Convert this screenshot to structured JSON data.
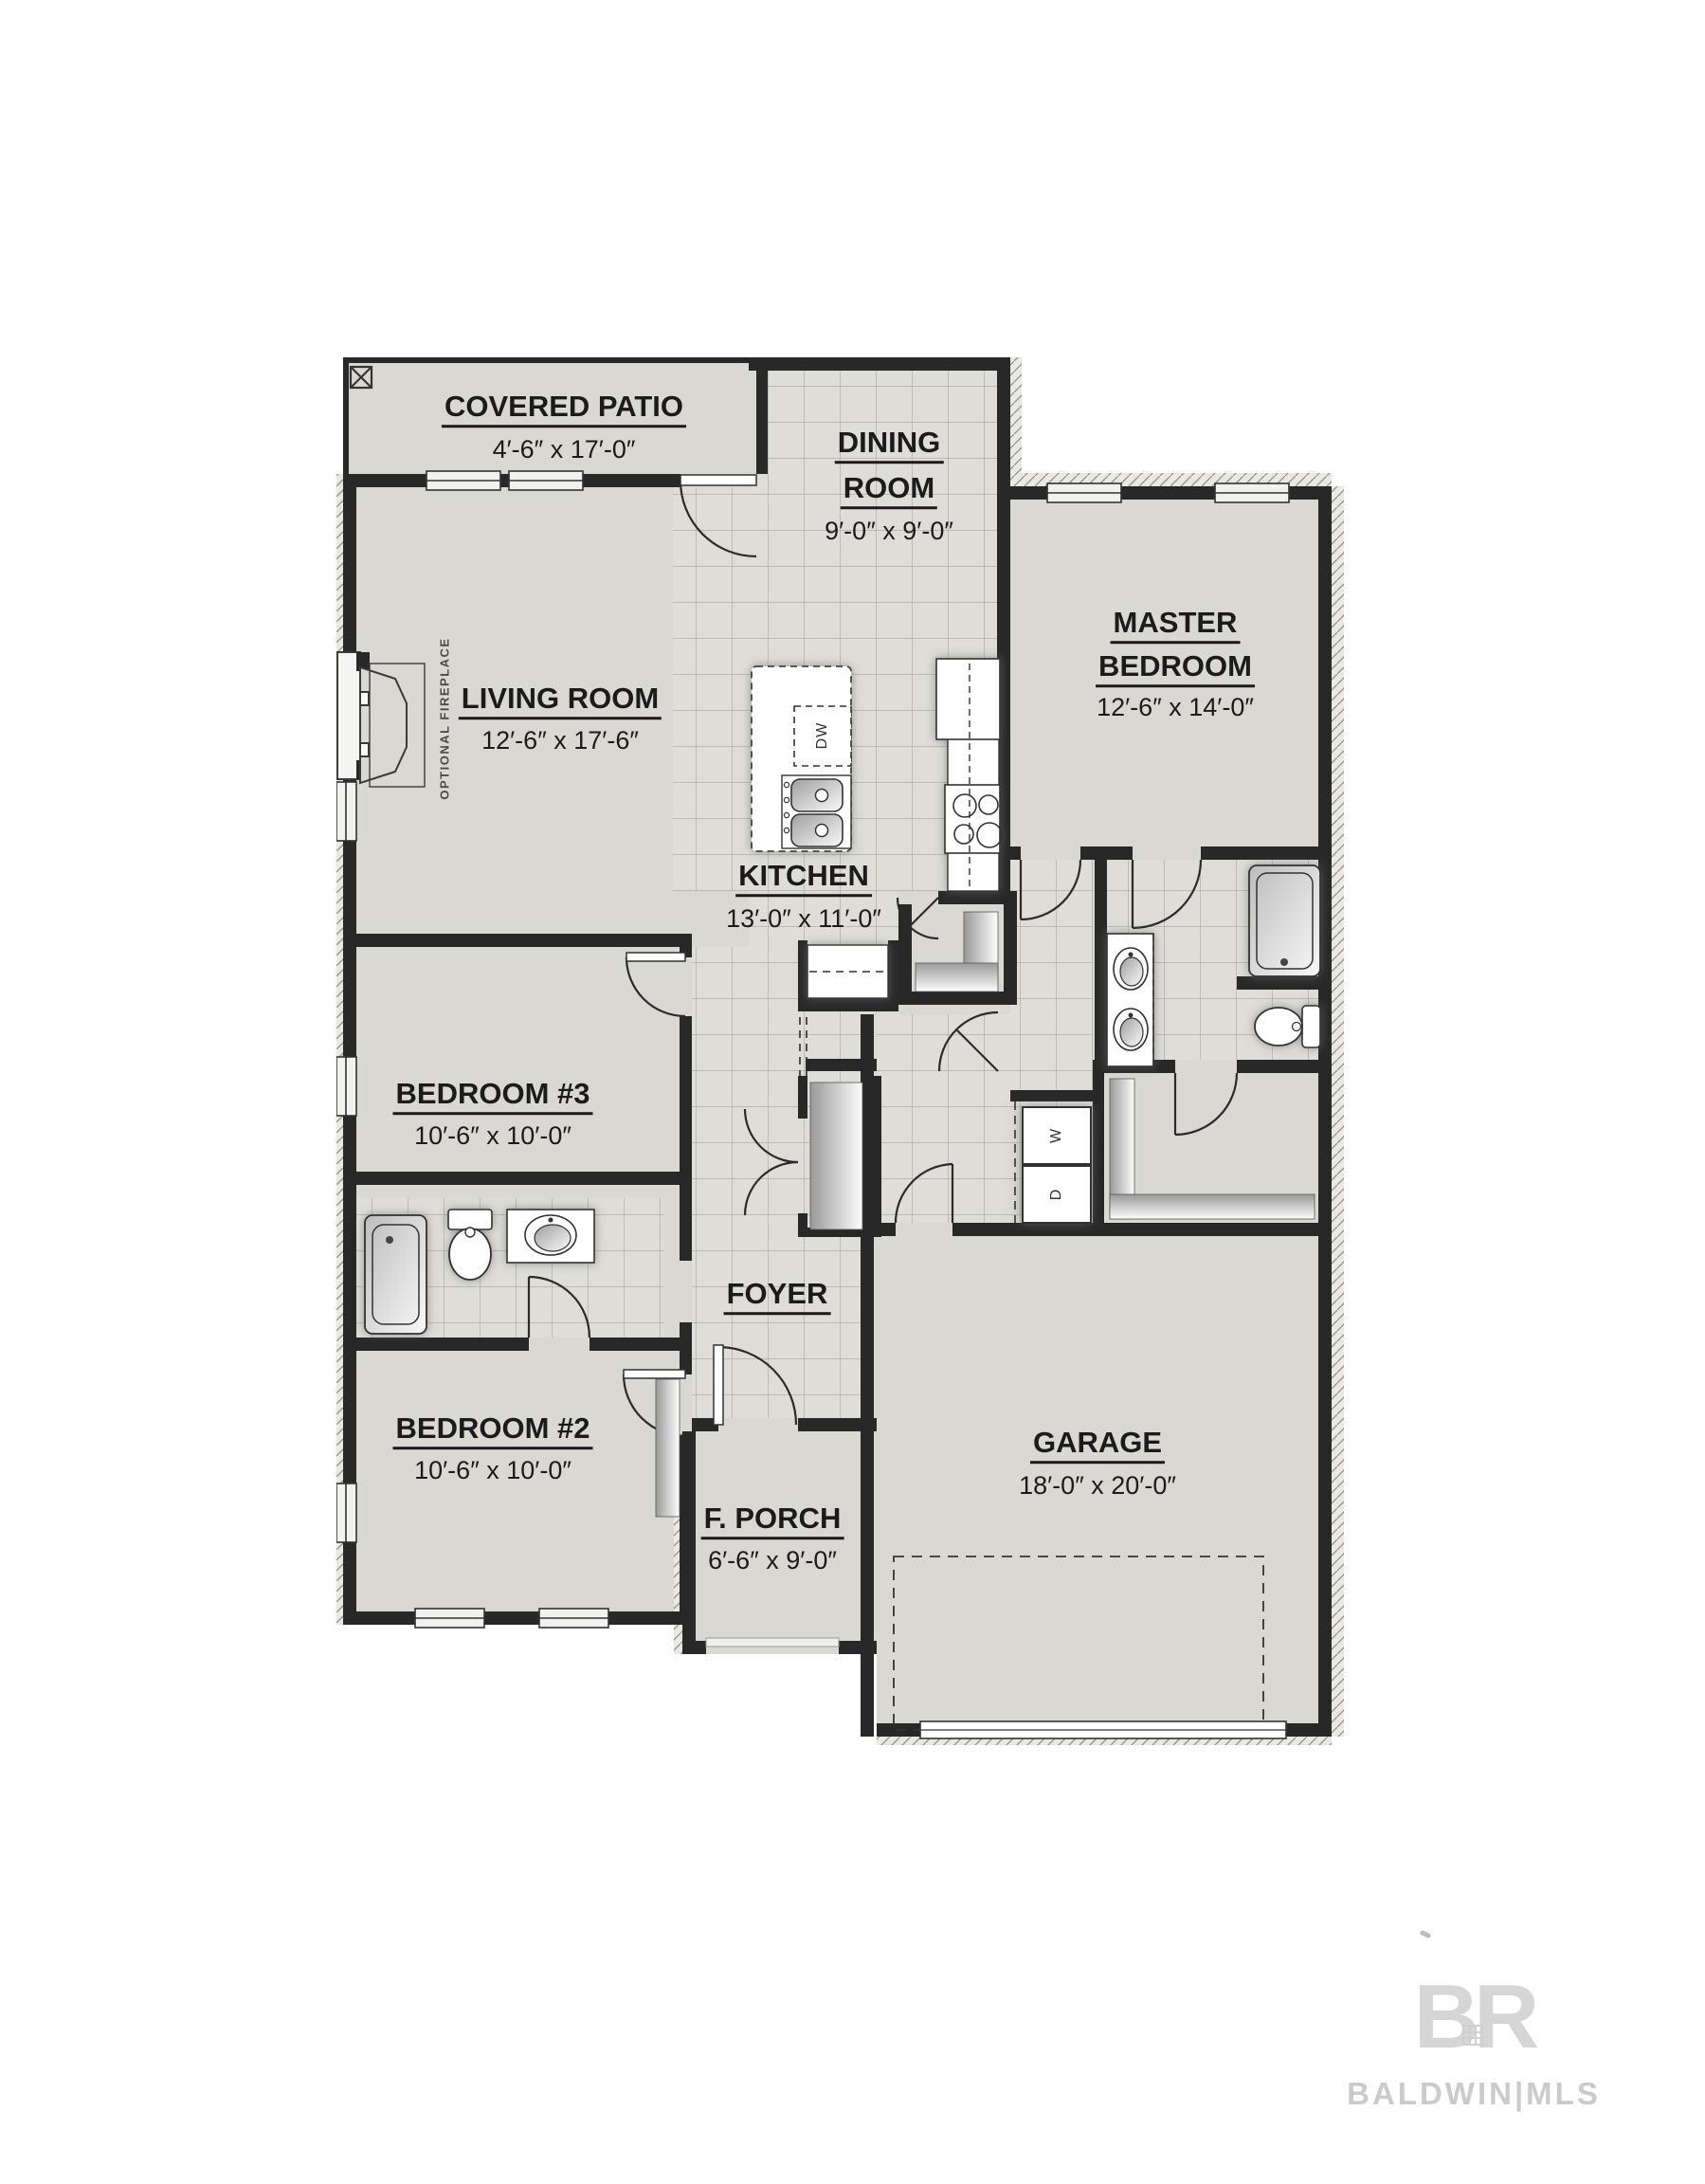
{
  "plan": {
    "rooms": {
      "covered_patio": {
        "label": "COVERED PATIO",
        "dims": "4′-6″ x 17′-0″"
      },
      "dining": {
        "line1": "DINING",
        "line2": "ROOM",
        "dims": "9′-0″ x 9′-0″"
      },
      "master": {
        "line1": "MASTER",
        "line2": "BEDROOM",
        "dims": "12′-6″ x 14′-0″"
      },
      "living": {
        "label": "LIVING ROOM",
        "dims": "12′-6″ x 17′-6″"
      },
      "kitchen": {
        "label": "KITCHEN",
        "dims": "13′-0″ x 11′-0″"
      },
      "bedroom3": {
        "label": "BEDROOM #3",
        "dims": "10′-6″ x 10′-0″"
      },
      "foyer": {
        "label": "FOYER"
      },
      "bedroom2": {
        "label": "BEDROOM #2",
        "dims": "10′-6″ x 10′-0″"
      },
      "porch": {
        "label": "F. PORCH",
        "dims": "6′-6″ x 9′-0″"
      },
      "garage": {
        "label": "GARAGE",
        "dims": "18′-0″ x 20′-0″"
      }
    },
    "annotations": {
      "fireplace": "OPTIONAL FIREPLACE",
      "dishwasher": "DW",
      "washer": "W",
      "dryer": "D"
    }
  },
  "watermark": {
    "logo": "BR",
    "brand": "BALDWIN|MLS"
  },
  "colors": {
    "wall": "#282828",
    "room_fill": "#d9d8d3",
    "tile_fill": "#deddd8",
    "label_text": "#1b1b1b",
    "watermark_gray": "#cbcbcb"
  }
}
